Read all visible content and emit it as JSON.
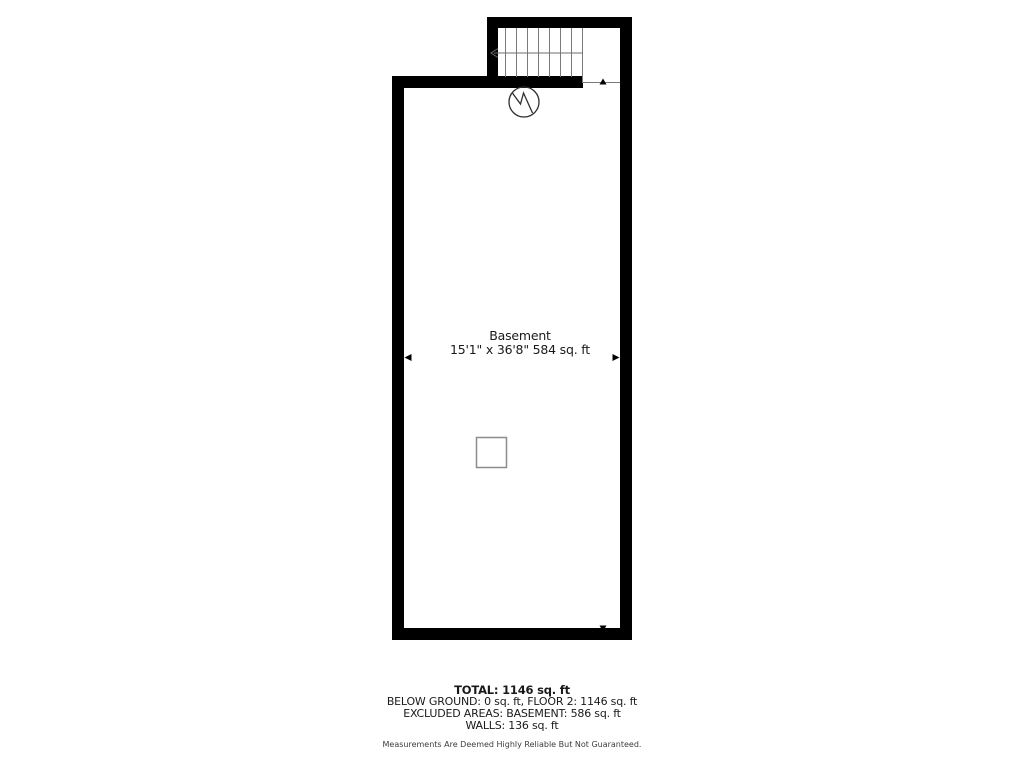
{
  "room": {
    "name": "Basement",
    "dimensions": "15'1\" x 36'8\" 584 sq. ft"
  },
  "summary": {
    "total": "TOTAL: 1146 sq. ft",
    "below_ground": "BELOW GROUND: 0 sq. ft, FLOOR 2: 1146 sq. ft",
    "excluded_areas": "EXCLUDED AREAS: BASEMENT: 586 sq. ft",
    "walls": "WALLS: 136 sq. ft",
    "disclaimer": "Measurements Are Deemed Highly Reliable But Not Guaranteed."
  },
  "symbols": {
    "stair_direction": "left-arrow",
    "detector": "circle-zigzag-icon",
    "support_post": "square-outline",
    "dimension_markers": [
      "left",
      "right",
      "up",
      "down"
    ]
  },
  "colors": {
    "background": "#ffffff",
    "wall": "#000000",
    "stair_line": "#7a7a7a",
    "symbol_stroke": "#2e2e2e",
    "post_border": "#8c8c8c",
    "label_text": "#1a1a1a",
    "disclaimer_text": "#3d3d3d"
  }
}
